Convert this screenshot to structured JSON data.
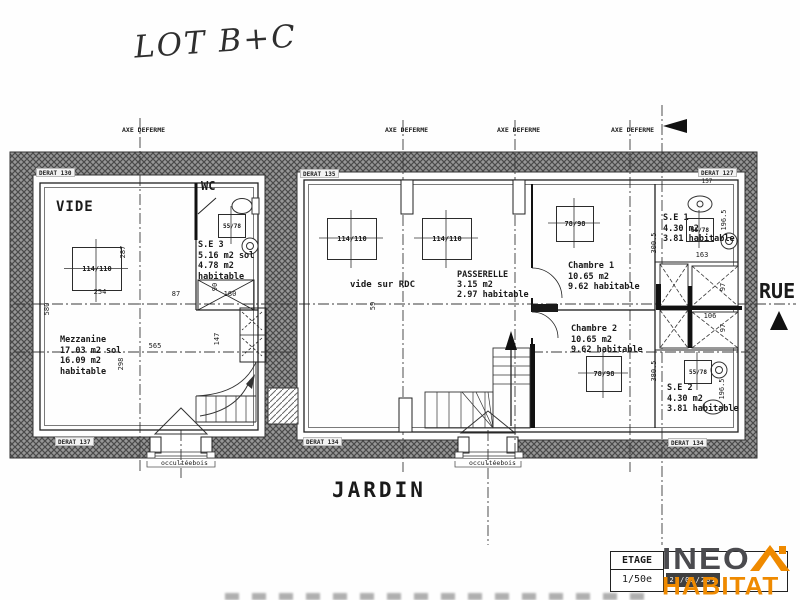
{
  "annotations": {
    "lot": "LOT B+C",
    "jardin": "JARDIN",
    "rue": "RUE",
    "axe_line1": "AXE DE",
    "axe_line2": "FERME"
  },
  "rooms": {
    "vide": "VIDE",
    "wc": "WC",
    "vide_sur_rdc": "vide sur RDC",
    "mezzanine": {
      "lines": [
        "Mezzanine",
        "17.03 m2 sol",
        "16.09 m2",
        "habitable"
      ]
    },
    "se3": {
      "lines": [
        "S.E 3",
        "5.16 m2 sol",
        "4.78 m2",
        "habitable"
      ]
    },
    "passerelle": {
      "lines": [
        "PASSERELLE",
        "3.15 m2",
        "2.97 habitable"
      ]
    },
    "chambre1": {
      "lines": [
        "Chambre 1",
        "10.65 m2",
        "9.62 habitable"
      ]
    },
    "chambre2": {
      "lines": [
        "Chambre 2",
        "10.65 m2",
        "9.62 habitable"
      ]
    },
    "se1": {
      "lines": [
        "S.E 1",
        "4.30 m2",
        "3.81 habitable"
      ]
    },
    "se2": {
      "lines": [
        "S.E 2",
        "4.30 m2",
        "3.81 habitable"
      ]
    }
  },
  "openings": {
    "w114": "114/110",
    "w78": "78/98",
    "w55": "55/78",
    "occultee_line1": "occultée",
    "occultee_line2": "bois"
  },
  "dimensions": {
    "d287": "287",
    "d254": "254",
    "d87": "87",
    "d90": "90",
    "d180": "180",
    "d580": "580",
    "d298": "298",
    "d565": "565",
    "d147": "147",
    "d59": "59",
    "d163": "163",
    "d196": "196.5",
    "d300": "300.5",
    "d97": "97",
    "d106": "106",
    "d380": "380.5",
    "d157": "157"
  },
  "wall_tags": {
    "t130": "DERAT 130",
    "t135": "DERAT 135",
    "t127": "DERAT 127",
    "t137": "DERAT 137",
    "t134": "DERAT 134"
  },
  "titleblock": {
    "level": "ETAGE",
    "scale": "1/50e",
    "date": "27/05/201"
  },
  "logo": {
    "name_top": "INEO",
    "name_bottom": "HABITAT",
    "orange": "#ef8a00",
    "gray": "#4b4b4f"
  },
  "colors": {
    "wall": "#969696",
    "line": "#1f1f1f",
    "paper": "#ffffff"
  }
}
